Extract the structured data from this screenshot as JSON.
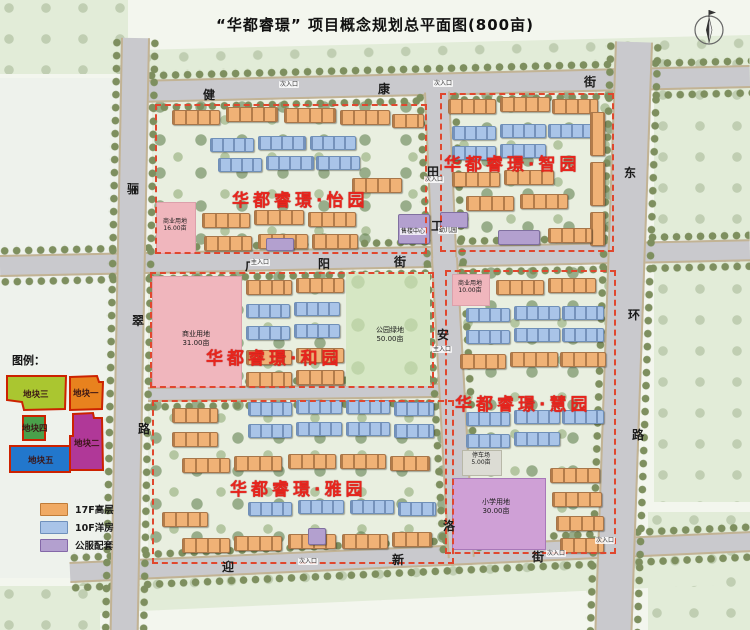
{
  "title": "“华都睿璟” 项目概念规划总平面图(800亩)",
  "communities": [
    {
      "name": "华都睿璟·怡园"
    },
    {
      "name": "华都睿璟·智园"
    },
    {
      "name": "华都睿璟·和园"
    },
    {
      "name": "华都睿璟·慧园"
    },
    {
      "name": "华都睿璟·雅园"
    }
  ],
  "roads": {
    "jiankang": {
      "name": "健康街",
      "chars": [
        "健",
        "康",
        "街"
      ]
    },
    "guangyang": {
      "name": "广阳街",
      "chars": [
        "广",
        "阳",
        "街"
      ]
    },
    "yingxin": {
      "name": "迎新街",
      "chars": [
        "迎",
        "新",
        "街"
      ]
    },
    "licui": {
      "name": "骊翠路",
      "chars": [
        "骊",
        "翠",
        "路"
      ]
    },
    "donghuan": {
      "name": "东环路",
      "chars": [
        "东",
        "环",
        "路"
      ]
    },
    "tiangong": {
      "name": "田工街",
      "chars": [
        "田",
        "工"
      ]
    },
    "anluo": {
      "name": "安洛街",
      "chars": [
        "安",
        "洛"
      ]
    }
  },
  "areas": {
    "commercial_west": {
      "label": "商业用地",
      "area": "31.00亩"
    },
    "commercial_yi": {
      "label": "商业用地",
      "area": "16.00亩"
    },
    "commercial_hui": {
      "label": "商业用地",
      "area": "10.00亩"
    },
    "park": {
      "label": "公园绿地",
      "area": "50.00亩"
    },
    "school": {
      "label": "小学用地",
      "area": "30.00亩"
    },
    "parking": {
      "label": "停车场",
      "area": "5.00亩"
    },
    "kindergarten": {
      "label": "幼儿园"
    },
    "sales_center": {
      "label": "售楼中心"
    }
  },
  "entrances": {
    "main": "主入口",
    "secondary": "次入口"
  },
  "legend": {
    "title": "图例：",
    "plots": [
      {
        "label": "地块一",
        "color": "#e8821e"
      },
      {
        "label": "地块二",
        "color": "#b03898"
      },
      {
        "label": "地块三",
        "color": "#aac630"
      },
      {
        "label": "地块四",
        "color": "#4aa04a"
      },
      {
        "label": "地块五",
        "color": "#2277cc"
      }
    ],
    "types": [
      {
        "label": "17F高层",
        "color": "#f0aa64"
      },
      {
        "label": "10F洋房",
        "color": "#a9c4e8"
      },
      {
        "label": "公服配套",
        "color": "#b3a0cf"
      }
    ]
  },
  "colors": {
    "community_label": "#e8251d",
    "plot_border": "#e0472e",
    "road": "#c9c9cd"
  }
}
